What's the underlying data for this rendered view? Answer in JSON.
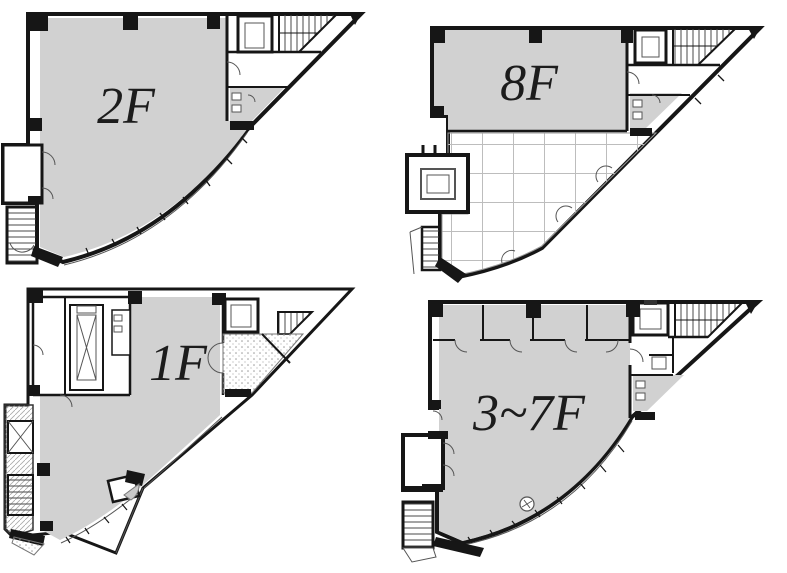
{
  "document": {
    "type": "building-floor-plans",
    "background": "#ffffff"
  },
  "floors": [
    {
      "id": "2f",
      "label": "2F",
      "position": "top-left"
    },
    {
      "id": "8f",
      "label": "8F",
      "position": "top-right"
    },
    {
      "id": "1f",
      "label": "1F",
      "position": "bottom-left"
    },
    {
      "id": "3-7f",
      "label": "3~7F",
      "position": "bottom-right"
    }
  ],
  "colors": {
    "floor_fill": "#d1d1d1",
    "wall": "#161616",
    "grid_line": "#bdbdbd",
    "background": "#ffffff"
  }
}
